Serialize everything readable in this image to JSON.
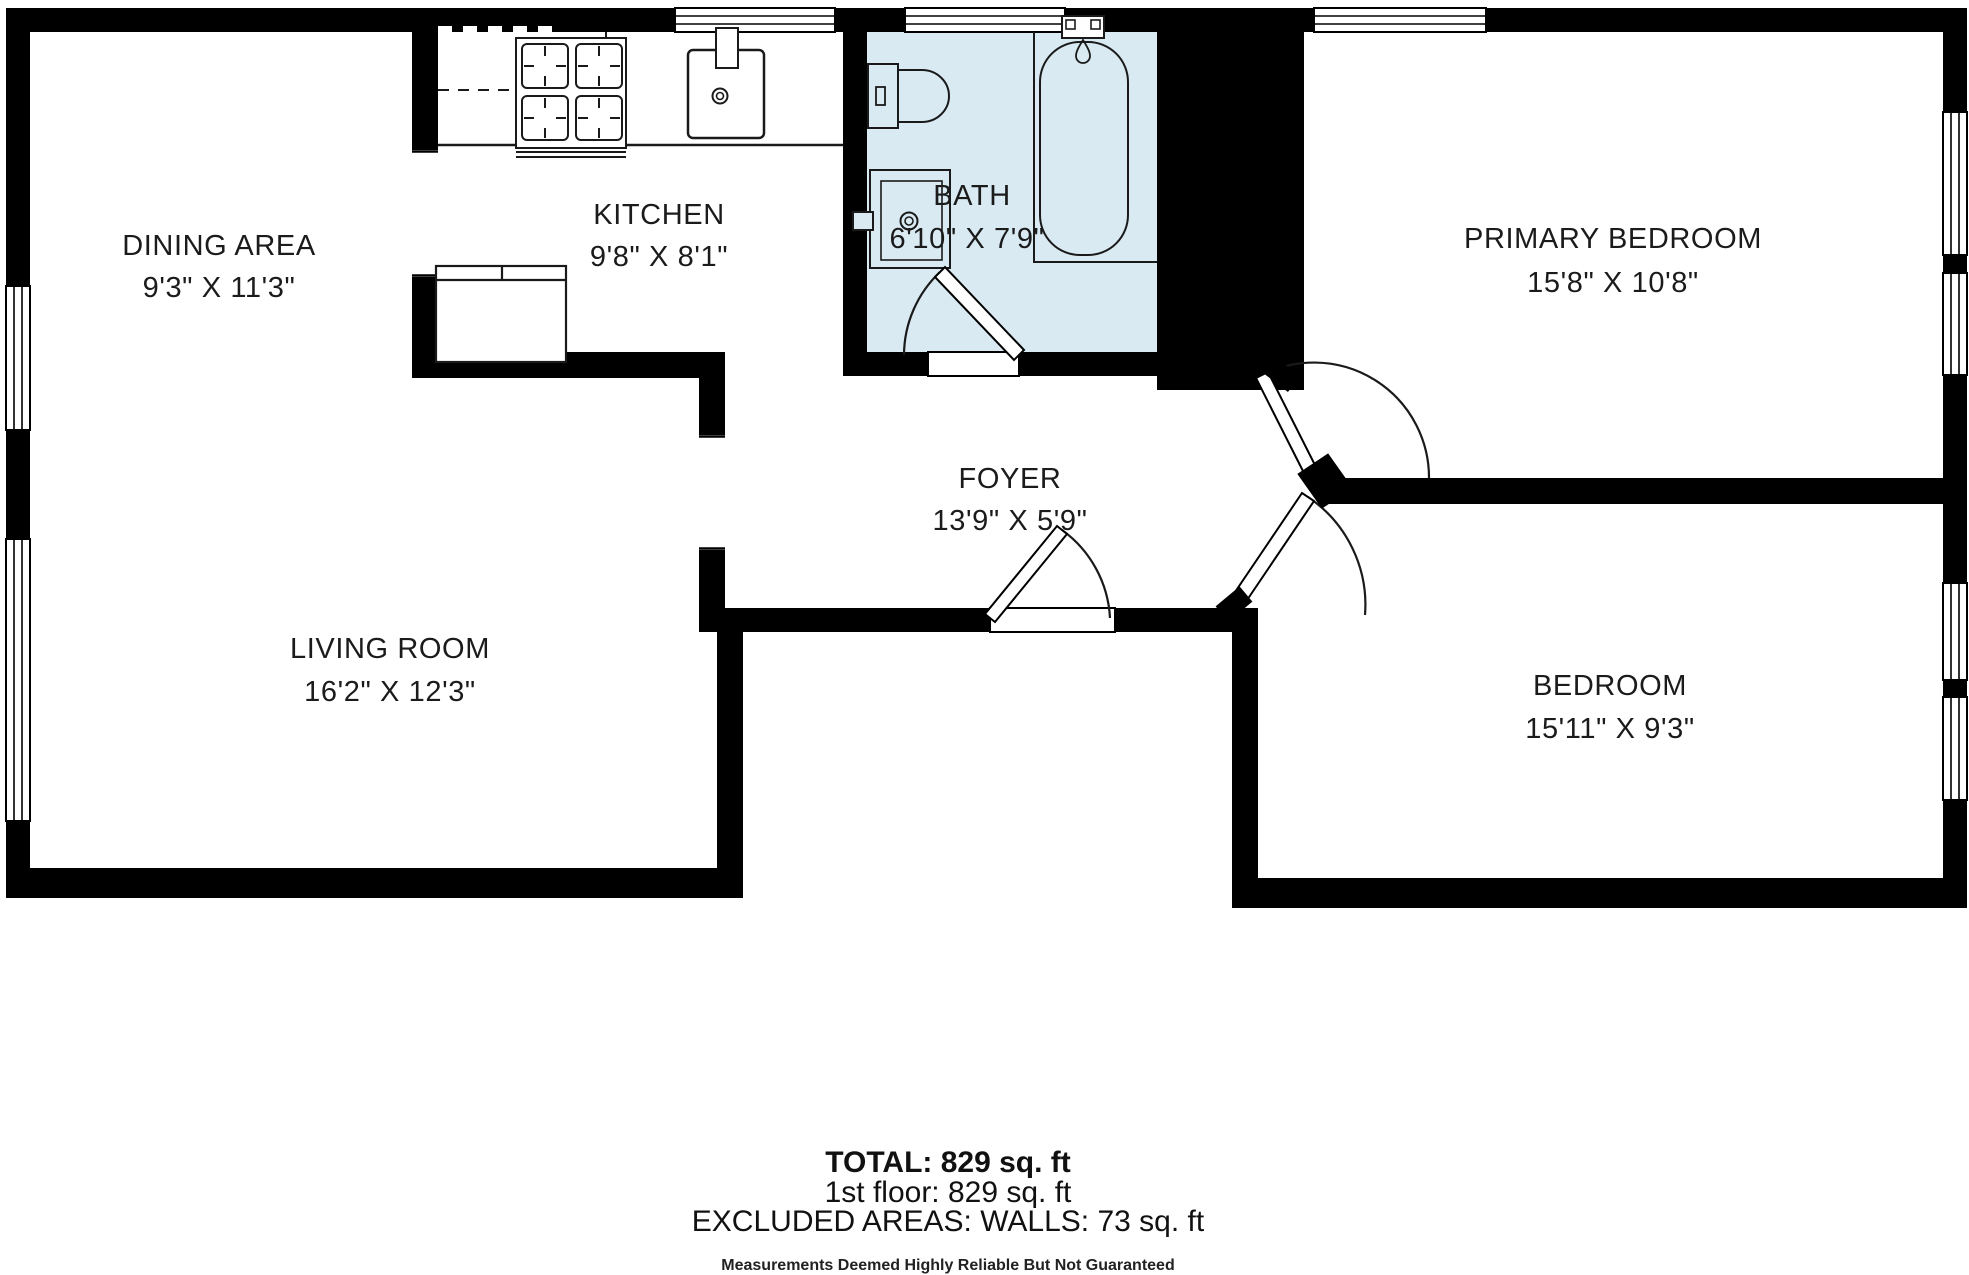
{
  "floorplan": {
    "rooms": [
      {
        "id": "dining",
        "name": "DINING AREA",
        "dims": "9'3\" X 11'3\""
      },
      {
        "id": "kitchen",
        "name": "KITCHEN",
        "dims": "9'8\" X 8'1\""
      },
      {
        "id": "bath",
        "name": "BATH",
        "dims": "6'10\" X 7'9\""
      },
      {
        "id": "primary-bedroom",
        "name": "PRIMARY BEDROOM",
        "dims": "15'8\" X 10'8\""
      },
      {
        "id": "foyer",
        "name": "FOYER",
        "dims": "13'9\" X 5'9\""
      },
      {
        "id": "living-room",
        "name": "LIVING ROOM",
        "dims": "16'2\" X 12'3\""
      },
      {
        "id": "bedroom",
        "name": "BEDROOM",
        "dims": "15'11\" X 9'3\""
      }
    ],
    "summary": {
      "total": "TOTAL: 829 sq. ft",
      "first_floor": "1st floor: 829 sq. ft",
      "excluded": "EXCLUDED AREAS: WALLS: 73 sq. ft",
      "disclaimer": "Measurements Deemed Highly Reliable But Not Guaranteed"
    },
    "fixtures": [
      "stove",
      "kitchen-sink",
      "refrigerator",
      "toilet",
      "bathroom-vanity-sink",
      "bathtub"
    ],
    "colors": {
      "wall": "#000000",
      "bath_fill": "#d9eaf3",
      "text": "#1b1b1b",
      "background": "#ffffff"
    }
  }
}
